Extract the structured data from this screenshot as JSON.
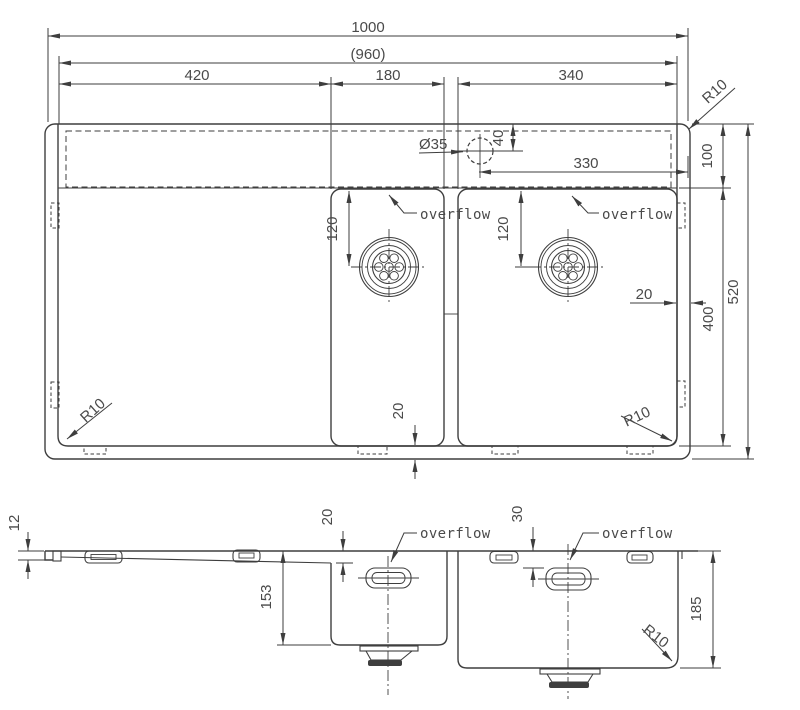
{
  "colors": {
    "line": "#3e3e3e",
    "text": "#4a4a4a",
    "background": "#ffffff"
  },
  "top_view": {
    "dims": {
      "overall_width": "1000",
      "inner_width": "(960)",
      "drainboard_width": "420",
      "small_bowl_width": "180",
      "large_bowl_width": "340",
      "faucet_hole_diameter": "Ø35",
      "faucet_hole_from_top_edge": "40",
      "faucet_hole_to_right_edge": "330",
      "deck_depth": "100",
      "bowl_front_depth": "400",
      "overall_depth": "520",
      "right_rim_width": "20",
      "bottom_rim_width": "20",
      "small_bowl_drain_offset": "120",
      "large_bowl_drain_offset": "120",
      "corner_radius_top_right": "R10",
      "corner_radius_bottom_left": "R10",
      "corner_radius_bottom_right": "R10"
    },
    "labels": {
      "overflow_small_bowl": "overflow",
      "overflow_large_bowl": "overflow"
    }
  },
  "side_view": {
    "dims": {
      "front_lip_height": "12",
      "drainboard_drop": "20",
      "overflow_drop": "30",
      "small_bowl_depth": "153",
      "large_bowl_depth": "185",
      "bottom_corner_radius": "R10"
    },
    "labels": {
      "overflow_small_bowl": "overflow",
      "overflow_large_bowl": "overflow"
    }
  }
}
